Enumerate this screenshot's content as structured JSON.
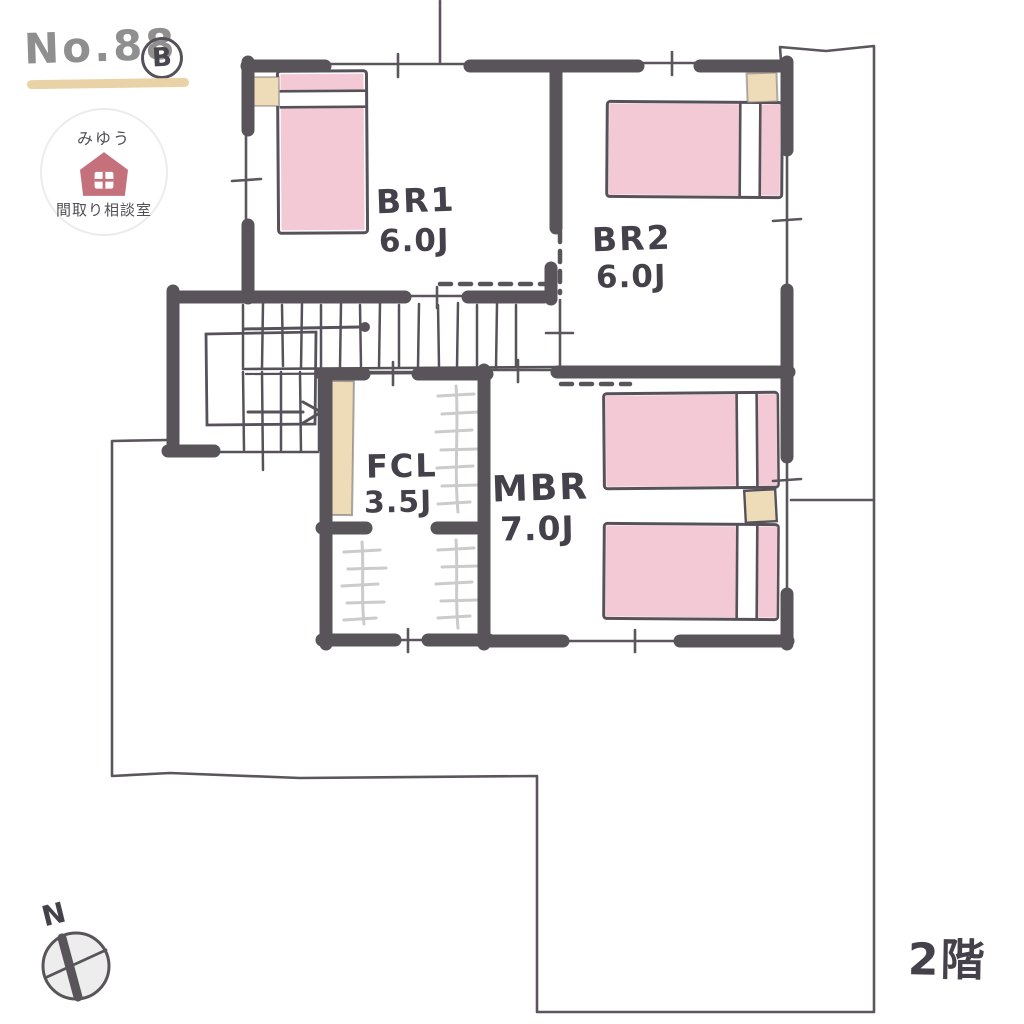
{
  "header": {
    "plan_number": "No.88",
    "plan_variant": "B"
  },
  "logo": {
    "name_top": "みゆう",
    "name_bottom": "間取り相談室"
  },
  "rooms": [
    {
      "name": "BR1",
      "size": "6.0J"
    },
    {
      "name": "BR2",
      "size": "6.0J"
    },
    {
      "name": "FCL",
      "size": "3.5J"
    },
    {
      "name": "MBR",
      "size": "7.0J"
    }
  ],
  "floor_label": "2階",
  "compass": {
    "north_label": "N"
  },
  "colors": {
    "wall": "#59545a",
    "thin_line": "#5b565c",
    "bed_fill": "#f2c9d4",
    "furniture_fill": "#eedcb8",
    "accent_underline": "#e9d2a6",
    "logo_house": "#c4717c",
    "hanger_sketch": "#cbcbcb",
    "compass_fill": "#ededed",
    "title_text": "#8f8f8f"
  }
}
